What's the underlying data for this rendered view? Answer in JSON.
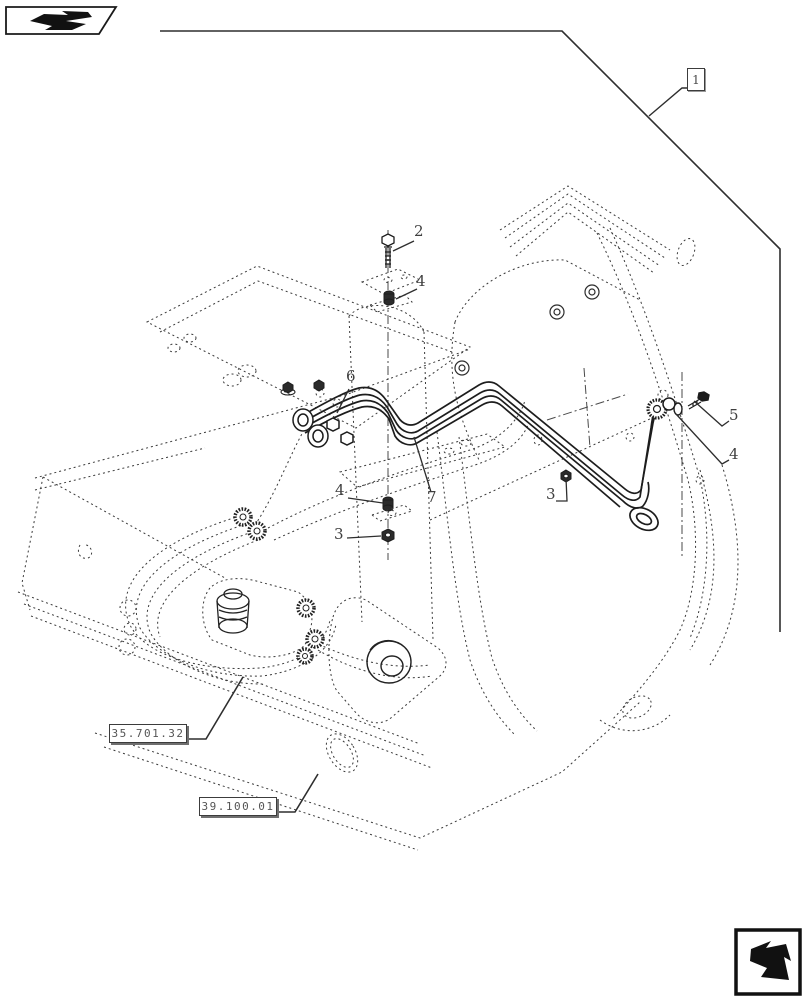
{
  "page": {
    "type": "parts-diagram",
    "background_color": "#ffffff",
    "line_color": "#2e2e2e",
    "label_color": "#3f3f3f"
  },
  "nav": {
    "prev_icon": "page-back-arrow",
    "next_icon": "page-forward-arrow"
  },
  "diagram": {
    "frame_callout": {
      "label": "1"
    },
    "part_callouts": [
      {
        "label": "2"
      },
      {
        "label": "4"
      },
      {
        "label": "6"
      },
      {
        "label": "4"
      },
      {
        "label": "3"
      },
      {
        "label": "7"
      },
      {
        "label": "3"
      },
      {
        "label": "5"
      },
      {
        "label": "4"
      }
    ],
    "reference_boxes": [
      {
        "label": "35.701.32"
      },
      {
        "label": "39.100.01"
      }
    ]
  }
}
